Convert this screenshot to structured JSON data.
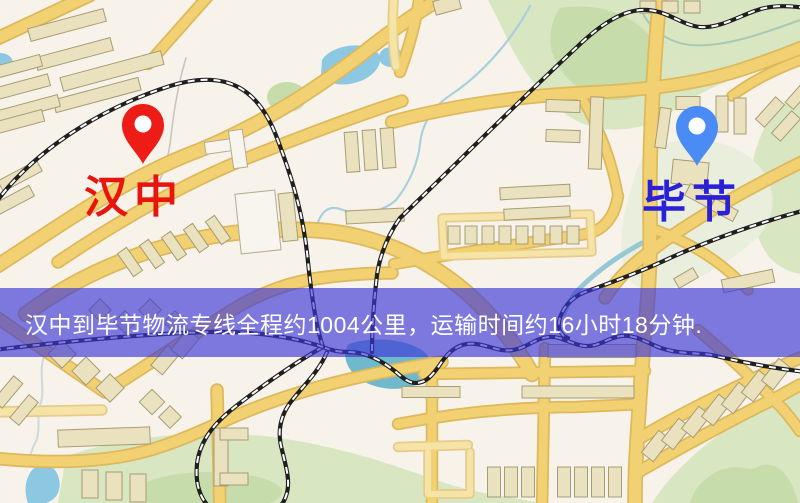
{
  "banner": {
    "text": "汉中到毕节物流专线全程约1004公里，运输时间约16小时18分钟.",
    "bg": "rgba(58,54,213,0.65)",
    "text_color": "#ffffff"
  },
  "map": {
    "markers": [
      {
        "id": "origin",
        "label": "汉中",
        "pin_color": "#ee1c16",
        "label_color": "#e8140e"
      },
      {
        "id": "destination",
        "label": "毕节",
        "pin_color": "#4b8bf5",
        "label_color": "#2a20d8"
      }
    ],
    "palette": {
      "background": "#f7f3ea",
      "road_fill": "#f2d173",
      "road_casing": "#ddb95c",
      "minor_road_fill": "#f6e3a6",
      "minor_road_casing": "#e6cc8c",
      "park_green": "#d8e6c2",
      "park_green_dark": "#c6dcaa",
      "park_green_pale": "#e9efdc",
      "water_blue": "#8cc8e2",
      "water_teal": "#70b9cc",
      "railway_dark": "#1f1f1f",
      "railway_dash": "#ffffff",
      "building_fill": "#eae1bf",
      "building_stroke": "#a89c74",
      "building_white_fill": "#f7f5ee",
      "building_white_stroke": "#b5ab93"
    }
  }
}
